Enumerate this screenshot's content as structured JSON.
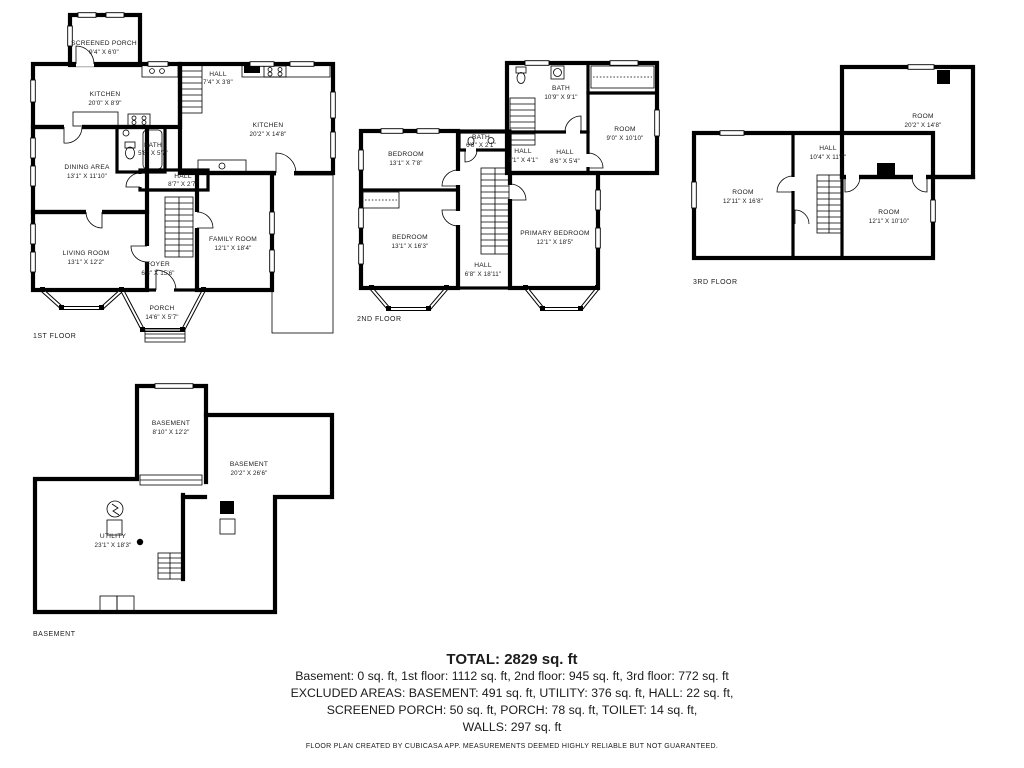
{
  "floors": {
    "first": {
      "label": "1ST FLOOR",
      "rooms": [
        {
          "name": "SCREENED PORCH",
          "dims": "9'4\" X 6'0\""
        },
        {
          "name": "KITCHEN",
          "dims": "20'0\" X 8'9\""
        },
        {
          "name": "HALL",
          "dims": "7'4\" X 3'8\""
        },
        {
          "name": "KITCHEN",
          "dims": "20'2\" X 14'8\""
        },
        {
          "name": "BATH",
          "dims": "5'8\" X 5'7\""
        },
        {
          "name": "DINING AREA",
          "dims": "13'1\" X 11'10\""
        },
        {
          "name": "HALL",
          "dims": "8'7\" X 2'7\""
        },
        {
          "name": "LIVING ROOM",
          "dims": "13'1\" X 12'2\""
        },
        {
          "name": "FAMILY ROOM",
          "dims": "12'1\" X 18'4\""
        },
        {
          "name": "FOYER",
          "dims": "6'8\" X 15'6\""
        },
        {
          "name": "PORCH",
          "dims": "14'6\" X 5'7\""
        }
      ]
    },
    "second": {
      "label": "2ND FLOOR",
      "rooms": [
        {
          "name": "BATH",
          "dims": "10'9\" X 9'1\""
        },
        {
          "name": "ROOM",
          "dims": "9'0\" X 10'10\""
        },
        {
          "name": "BEDROOM",
          "dims": "13'1\" X 7'8\""
        },
        {
          "name": "BATH",
          "dims": "6'8\" X 2'1\""
        },
        {
          "name": "HALL",
          "dims": "3'1\" X 4'1\""
        },
        {
          "name": "HALL",
          "dims": "8'6\" X 5'4\""
        },
        {
          "name": "BEDROOM",
          "dims": "13'1\" X 16'3\""
        },
        {
          "name": "PRIMARY BEDROOM",
          "dims": "12'1\" X 18'5\""
        },
        {
          "name": "HALL",
          "dims": "6'8\" X 18'11\""
        }
      ]
    },
    "third": {
      "label": "3RD FLOOR",
      "rooms": [
        {
          "name": "ROOM",
          "dims": "20'2\" X 14'8\""
        },
        {
          "name": "HALL",
          "dims": "10'4\" X 11'7\""
        },
        {
          "name": "ROOM",
          "dims": "12'11\" X 16'8\""
        },
        {
          "name": "ROOM",
          "dims": "12'1\" X 10'10\""
        }
      ]
    },
    "basement": {
      "label": "BASEMENT",
      "rooms": [
        {
          "name": "BASEMENT",
          "dims": "8'10\" X 12'2\""
        },
        {
          "name": "BASEMENT",
          "dims": "20'2\" X 26'6\""
        },
        {
          "name": "UTILITY",
          "dims": "23'1\" X 18'3\""
        }
      ]
    }
  },
  "summary": {
    "total": "TOTAL: 2829 sq. ft",
    "line1": "Basement: 0 sq. ft, 1st floor: 1112 sq. ft, 2nd floor: 945 sq. ft, 3rd floor: 772 sq. ft",
    "line2": "EXCLUDED AREAS: BASEMENT: 491 sq. ft, UTILITY: 376 sq. ft, HALL: 22 sq. ft,",
    "line3": "SCREENED PORCH: 50 sq. ft, PORCH: 78 sq. ft, TOILET: 14 sq. ft,",
    "line4": "WALLS: 297 sq. ft"
  },
  "footer": "FLOOR PLAN CREATED BY CUBICASA APP. MEASUREMENTS DEEMED HIGHLY RELIABLE BUT NOT GUARANTEED.",
  "colors": {
    "walls": "#000000",
    "background": "#ffffff",
    "text": "#1b1b1b"
  }
}
